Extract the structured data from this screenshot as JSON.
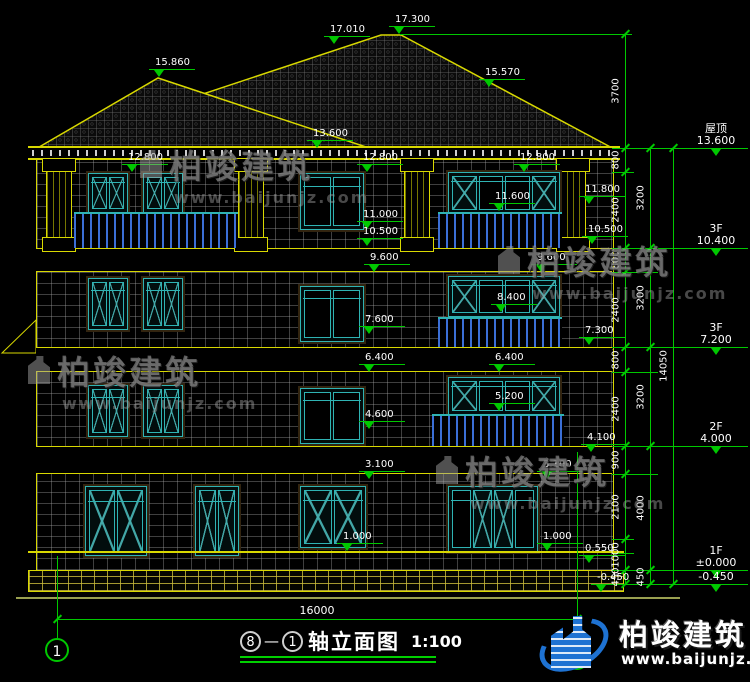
{
  "title": {
    "from": "8",
    "dash": "—",
    "to": "1",
    "name": "轴立面图",
    "scale": "1:100"
  },
  "axis": {
    "left_bubble": "1",
    "right_bubble": "8"
  },
  "bottom_dim": {
    "value": "16000"
  },
  "logo": {
    "name": "柏竣建筑",
    "url": "www.baijunjz.com"
  },
  "watermarks": [
    {
      "x": 140,
      "y": 140,
      "text": "柏竣建筑",
      "url": "www.baijunjz.com"
    },
    {
      "x": 28,
      "y": 346,
      "text": "柏竣建筑",
      "url": "www.baijunjz.com"
    },
    {
      "x": 498,
      "y": 236,
      "text": "柏竣建筑",
      "url": "www.baijunjz.com"
    },
    {
      "x": 436,
      "y": 446,
      "text": "柏竣建筑",
      "url": "www.baijunjz.com"
    }
  ],
  "drawing": {
    "markers": [
      {
        "v": "17.300",
        "x": 400,
        "y": 34
      },
      {
        "v": "17.010",
        "x": 335,
        "y": 44
      },
      {
        "v": "15.860",
        "x": 160,
        "y": 77
      },
      {
        "v": "15.570",
        "x": 490,
        "y": 87
      },
      {
        "v": "13.600",
        "x": 318,
        "y": 148
      },
      {
        "v": "12.800",
        "x": 133,
        "y": 172
      },
      {
        "v": "12.800",
        "x": 368,
        "y": 172
      },
      {
        "v": "12.800",
        "x": 525,
        "y": 172
      },
      {
        "v": "11.800",
        "x": 590,
        "y": 204
      },
      {
        "v": "11.600",
        "x": 500,
        "y": 211
      },
      {
        "v": "11.000",
        "x": 368,
        "y": 229
      },
      {
        "v": "10.500",
        "x": 368,
        "y": 246
      },
      {
        "v": "10.500",
        "x": 593,
        "y": 244
      },
      {
        "v": "9.600",
        "x": 375,
        "y": 272
      },
      {
        "v": "9.600",
        "x": 542,
        "y": 272
      },
      {
        "v": "8.400",
        "x": 502,
        "y": 312
      },
      {
        "v": "7.600",
        "x": 370,
        "y": 334
      },
      {
        "v": "7.300",
        "x": 590,
        "y": 345
      },
      {
        "v": "6.400",
        "x": 370,
        "y": 372
      },
      {
        "v": "6.400",
        "x": 500,
        "y": 372
      },
      {
        "v": "5.200",
        "x": 500,
        "y": 411
      },
      {
        "v": "4.600",
        "x": 370,
        "y": 429
      },
      {
        "v": "4.100",
        "x": 592,
        "y": 452
      },
      {
        "v": "3.100",
        "x": 370,
        "y": 479
      },
      {
        "v": "3.100",
        "x": 548,
        "y": 479
      },
      {
        "v": "1.000",
        "x": 348,
        "y": 551
      },
      {
        "v": "1.000",
        "x": 548,
        "y": 551
      },
      {
        "v": "0.550",
        "x": 590,
        "y": 563
      },
      {
        "v": "-0.450",
        "x": 602,
        "y": 592
      }
    ],
    "right_levels": [
      {
        "label": "屋顶",
        "value": "13.600",
        "y": 148
      },
      {
        "label": "3F",
        "value": "10.400",
        "y": 248
      },
      {
        "label": "3F",
        "value": "7.200",
        "y": 347
      },
      {
        "label": "2F",
        "value": "4.000",
        "y": 446
      },
      {
        "label": "1F",
        "value": "±0.000",
        "y": 570
      },
      {
        "label": "",
        "value": "-0.450",
        "y": 584
      }
    ],
    "dim_chains": [
      {
        "x": 625,
        "boundaries": [
          34,
          148,
          172,
          248,
          272,
          347,
          372,
          446,
          474,
          539,
          570,
          584
        ],
        "labels": [
          "3700",
          "800",
          "2400",
          "800",
          "2400",
          "800",
          "2400",
          "900",
          "2100",
          "1000",
          "450"
        ]
      },
      {
        "x": 650,
        "boundaries": [
          148,
          248,
          347,
          446,
          570,
          584
        ],
        "labels": [
          "3200",
          "3200",
          "3200",
          "4000",
          "450"
        ]
      },
      {
        "x": 673,
        "boundaries": [
          148,
          584
        ],
        "labels": [
          "14050"
        ]
      }
    ],
    "ext_lines": [
      [
        400,
        632,
        34
      ],
      [
        612,
        688,
        148
      ],
      [
        612,
        634,
        172
      ],
      [
        612,
        688,
        248
      ],
      [
        612,
        658,
        272
      ],
      [
        612,
        688,
        347
      ],
      [
        612,
        658,
        372
      ],
      [
        612,
        688,
        446
      ],
      [
        612,
        658,
        474
      ],
      [
        612,
        634,
        539
      ],
      [
        612,
        634,
        553
      ],
      [
        612,
        688,
        570
      ],
      [
        616,
        688,
        584
      ]
    ]
  }
}
